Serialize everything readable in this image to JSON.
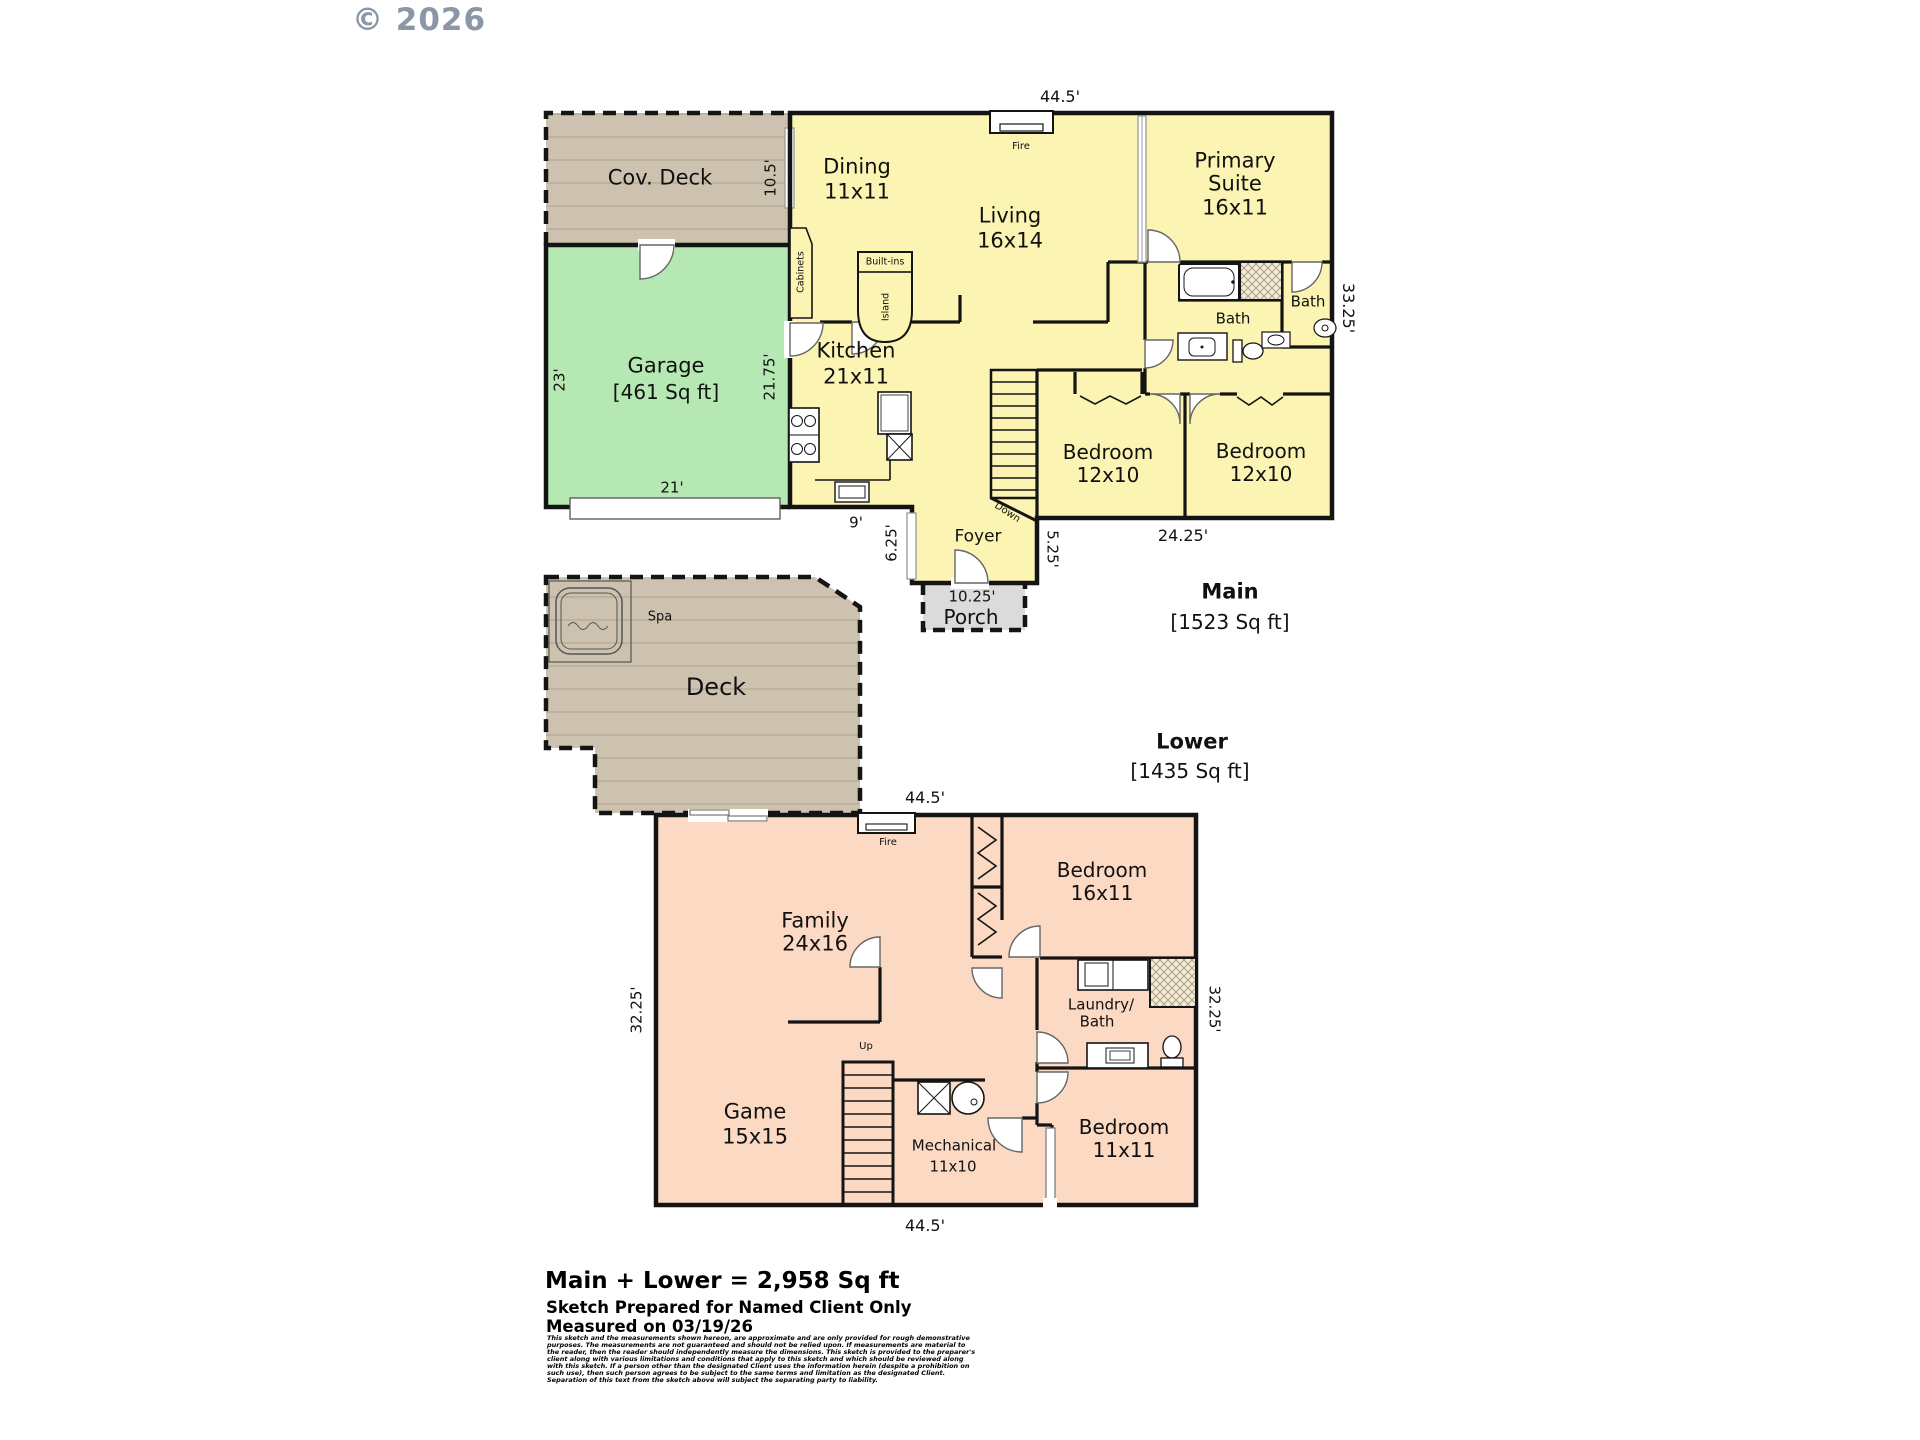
{
  "watermark": "© 2026",
  "main": {
    "title": "Main",
    "sqft": "[1523 Sq ft]",
    "dims": {
      "width_top": "44.5'",
      "height_right": "33.25'",
      "cov_deck": "10.5'",
      "garage_left": "23'",
      "house_left": "21.75'",
      "garage_door": "21'",
      "kitchen_bottom": "9'",
      "foyer_left": "6.25'",
      "foyer_right": "5.25'",
      "porch": "10.25'",
      "bedrooms": "24.25'"
    },
    "rooms": {
      "cov_deck": "Cov. Deck",
      "garage": "Garage",
      "garage_sqft": "[461 Sq ft]",
      "dining": "Dining",
      "dining_dim": "11x11",
      "living": "Living",
      "living_dim": "16x14",
      "kitchen": "Kitchen",
      "kitchen_dim": "21x11",
      "primary_line1": "Primary",
      "primary_line2": "Suite",
      "primary_dim": "16x11",
      "bath_hall": "Bath",
      "bath_primary": "Bath",
      "bedroom_left": "Bedroom",
      "bedroom_left_dim": "12x10",
      "bedroom_right": "Bedroom",
      "bedroom_right_dim": "12x10",
      "foyer": "Foyer",
      "porch": "Porch"
    },
    "features": {
      "fireplace": "Fire",
      "cabinets": "Cabinets",
      "island": "Island",
      "built_ins": "Built-ins",
      "stairs": "Down"
    }
  },
  "deck": {
    "label": "Deck",
    "spa": "Spa"
  },
  "lower": {
    "title": "Lower",
    "sqft": "[1435 Sq ft]",
    "dims": {
      "width_top": "44.5'",
      "width_bottom": "44.5'",
      "height_left": "32.25'",
      "height_right": "32.25'"
    },
    "rooms": {
      "family": "Family",
      "family_dim": "24x16",
      "bedroom_upper": "Bedroom",
      "bedroom_upper_dim": "16x11",
      "laundry_line1": "Laundry/",
      "laundry_line2": "Bath",
      "bedroom_lower": "Bedroom",
      "bedroom_lower_dim": "11x11",
      "game": "Game",
      "game_dim": "15x15",
      "mechanical": "Mechanical",
      "mechanical_dim": "11x10"
    },
    "features": {
      "fireplace": "Fire",
      "stairs": "Up"
    }
  },
  "footer": {
    "total": "Main + Lower = 2,958 Sq ft",
    "prepared_for": "Sketch Prepared for Named Client Only",
    "measured_on": "Measured on 03/19/26",
    "disclaimer": "This sketch and the measurements shown hereon, are approximate and are only provided for rough demonstrative purposes. The measurements are not guaranteed and should not be relied upon. If measurements are material to the reader, then the reader should independently measure the dimensions. This sketch is provided to the preparer's client along with various limitations and conditions that apply to this sketch and which should be reviewed along with this sketch. If a person other than the designated Client uses the information herein (despite a prohibition on such use), then such person agrees to be subject to the same terms and limitation as the designated Client. Separation of this text from the sketch above will subject the separating party to liability."
  },
  "colors": {
    "main_floor": "#fbf4b2",
    "garage": "#b5e8b2",
    "lower_floor": "#fbd9c3",
    "deck": "#cdc2b0",
    "porch": "#dbdbdb",
    "wall": "#141414"
  }
}
